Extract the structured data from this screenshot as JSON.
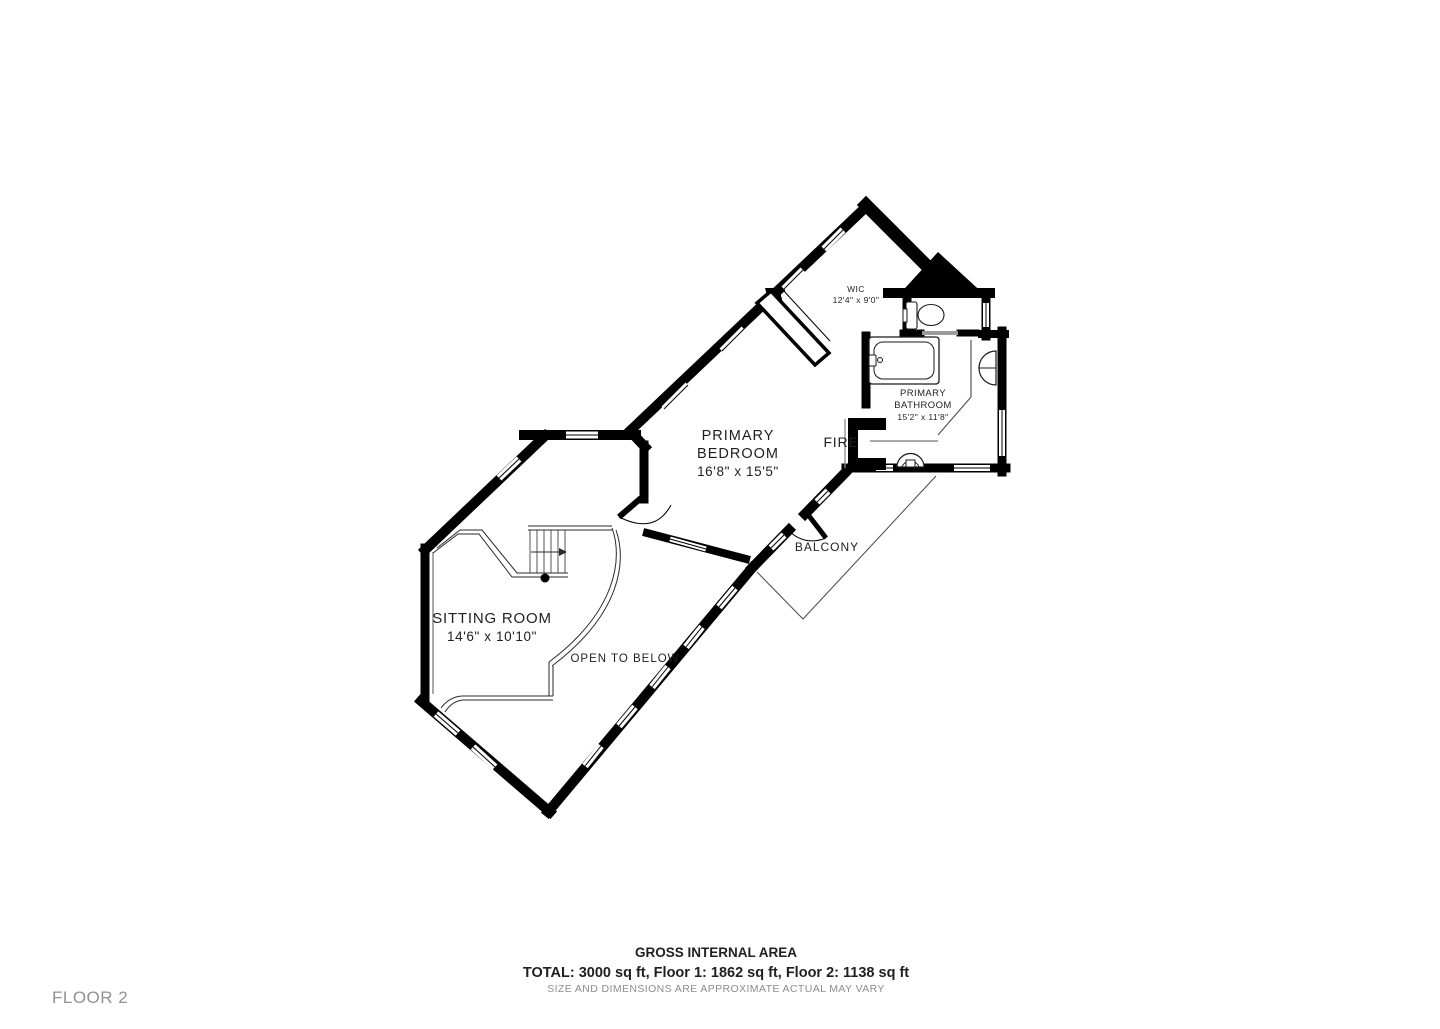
{
  "plan": {
    "rooms": {
      "wic": {
        "name": "WIC",
        "dims": "12'4\" x 9'0\""
      },
      "bedroom": {
        "name_line1": "PRIMARY",
        "name_line2": "BEDROOM",
        "dims": "16'8\" x 15'5\""
      },
      "bathroom": {
        "name_line1": "PRIMARY",
        "name_line2": "BATHROOM",
        "dims": "15'2\" x 11'8\""
      },
      "sitting_room": {
        "name": "SITTING ROOM",
        "dims": "14'6\" x 10'10\""
      },
      "fireplace": {
        "name": "FIRE"
      },
      "balcony": {
        "name": "BALCONY"
      },
      "open_to_below": {
        "name": "OPEN TO BELOW"
      }
    }
  },
  "footer": {
    "heading": "GROSS INTERNAL AREA",
    "totals": "TOTAL: 3000 sq ft, Floor 1: 1862 sq ft, Floor 2: 1138 sq ft",
    "disclaimer": "SIZE AND DIMENSIONS ARE APPROXIMATE ACTUAL MAY VARY",
    "floor_label": "FLOOR 2"
  },
  "colors": {
    "wall": "#000000",
    "text": "#1f1f1f",
    "muted": "#8d8d8d"
  }
}
